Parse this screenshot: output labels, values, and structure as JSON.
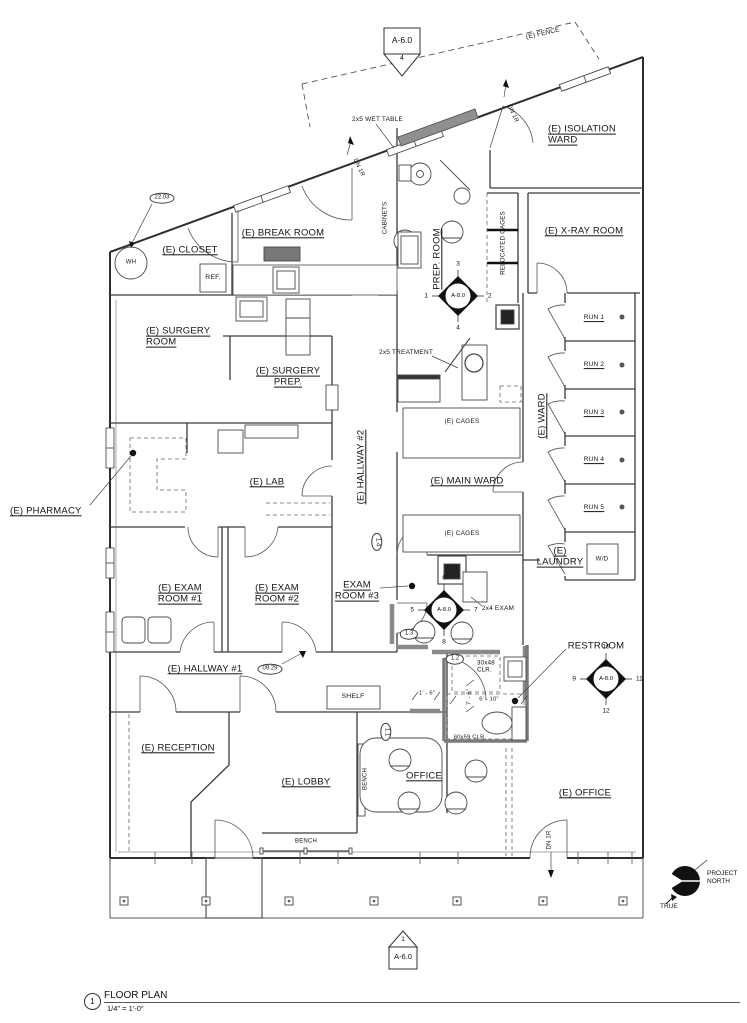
{
  "sheet_top": {
    "label": "A-6.0",
    "number": "4"
  },
  "sheet_bottom": {
    "label": "A-6.0",
    "number": "1"
  },
  "title_block": {
    "number": "1",
    "title": "FLOOR PLAN",
    "scale": "1/4\" = 1'-0\""
  },
  "north": {
    "project": "PROJECT\nNORTH",
    "true_label": "TRUE"
  },
  "plan": {
    "labels": [
      {
        "id": "room-label-isolation-ward",
        "text": "(E) ISOLATION\nWARD",
        "x": 548,
        "y": 135,
        "size": 9.5,
        "ul": true,
        "align": "left"
      },
      {
        "id": "room-label-xray",
        "text": "(E) X-RAY ROOM",
        "x": 584,
        "y": 231,
        "size": 9.5,
        "ul": true
      },
      {
        "id": "room-label-break-room",
        "text": "(E) BREAK ROOM",
        "x": 283,
        "y": 233,
        "size": 9.5,
        "ul": true
      },
      {
        "id": "room-label-closet",
        "text": "(E) CLOSET",
        "x": 190,
        "y": 250,
        "size": 9.5,
        "ul": true
      },
      {
        "id": "room-label-surgery-room",
        "text": "(E) SURGERY\nROOM",
        "x": 146,
        "y": 337,
        "size": 9.5,
        "ul": true,
        "align": "left"
      },
      {
        "id": "room-label-surgery-prep",
        "text": "(E) SURGERY\nPREP.",
        "x": 288,
        "y": 377,
        "size": 9.5,
        "ul": true
      },
      {
        "id": "room-label-prep-room",
        "text": "PREP. ROOM",
        "x": 437,
        "y": 259,
        "size": 9.5,
        "ul": true,
        "rot": -90
      },
      {
        "id": "room-label-hallway-2",
        "text": "(E) HALLWAY #2",
        "x": 361,
        "y": 467,
        "size": 9.5,
        "ul": true,
        "rot": -90
      },
      {
        "id": "room-label-main-ward",
        "text": "(E) MAIN WARD",
        "x": 467,
        "y": 481,
        "size": 9.5,
        "ul": true
      },
      {
        "id": "room-label-ward",
        "text": "(E) WARD",
        "x": 542,
        "y": 416,
        "size": 9.5,
        "ul": true,
        "rot": -90
      },
      {
        "id": "room-label-lab",
        "text": "(E) LAB",
        "x": 267,
        "y": 482,
        "size": 9.5,
        "ul": true
      },
      {
        "id": "room-label-pharmacy",
        "text": "(E)  PHARMACY",
        "x": 10,
        "y": 511,
        "size": 9.5,
        "ul": true,
        "align": "left"
      },
      {
        "id": "room-label-exam-1",
        "text": "(E) EXAM\nROOM #1",
        "x": 180,
        "y": 594,
        "size": 9.5,
        "ul": true
      },
      {
        "id": "room-label-exam-2",
        "text": "(E) EXAM\nROOM #2",
        "x": 277,
        "y": 594,
        "size": 9.5,
        "ul": true
      },
      {
        "id": "room-label-exam-3",
        "text": "EXAM\nROOM #3",
        "x": 357,
        "y": 591,
        "size": 9.5,
        "ul": true
      },
      {
        "id": "room-label-hallway-1",
        "text": "(E) HALLWAY #1",
        "x": 205,
        "y": 669,
        "size": 9.5,
        "ul": true
      },
      {
        "id": "room-label-laundry",
        "text": "(E)\nLAUNDRY",
        "x": 560,
        "y": 557,
        "size": 9.5,
        "ul": true
      },
      {
        "id": "room-label-restroom",
        "text": "RESTROOM",
        "x": 596,
        "y": 646,
        "size": 9.5
      },
      {
        "id": "room-label-reception",
        "text": "(E) RECEPTION",
        "x": 178,
        "y": 748,
        "size": 9.5,
        "ul": true
      },
      {
        "id": "room-label-lobby",
        "text": "(E) LOBBY",
        "x": 306,
        "y": 782,
        "size": 9.5,
        "ul": true
      },
      {
        "id": "room-label-office",
        "text": "OFFICE",
        "x": 424,
        "y": 776,
        "size": 9.5,
        "ul": true
      },
      {
        "id": "room-label-e-office",
        "text": "(E) OFFICE",
        "x": 585,
        "y": 793,
        "size": 9.5,
        "ul": true
      },
      {
        "id": "run-label-1",
        "text": "RUN 1",
        "x": 594,
        "y": 318,
        "size": 6.5,
        "ul": true
      },
      {
        "id": "run-label-2",
        "text": "RUN 2",
        "x": 594,
        "y": 365,
        "size": 6.5,
        "ul": true
      },
      {
        "id": "run-label-3",
        "text": "RUN 3",
        "x": 594,
        "y": 413,
        "size": 6.5,
        "ul": true
      },
      {
        "id": "run-label-4",
        "text": "RUN 4",
        "x": 594,
        "y": 460,
        "size": 6.5,
        "ul": true
      },
      {
        "id": "run-label-5",
        "text": "RUN 5",
        "x": 594,
        "y": 508,
        "size": 6.5,
        "ul": true
      },
      {
        "id": "anno-wet-table",
        "text": "2x5 WET TABLE",
        "x": 352,
        "y": 120,
        "size": 6.5,
        "align": "left"
      },
      {
        "id": "anno-treatment",
        "text": "2x5 TREATMENT",
        "x": 379,
        "y": 353,
        "size": 6.5,
        "align": "left"
      },
      {
        "id": "anno-cabinets",
        "text": "CABINETS",
        "x": 385,
        "y": 218,
        "size": 6.2,
        "rot": -90
      },
      {
        "id": "anno-relocated-cages",
        "text": "RELOCATED CAGES",
        "x": 503,
        "y": 243,
        "size": 6.2,
        "rot": -90
      },
      {
        "id": "anno-cages-1",
        "text": "(E) CAGES",
        "x": 462,
        "y": 422,
        "size": 6.5
      },
      {
        "id": "anno-cages-2",
        "text": "(E) CAGES",
        "x": 462,
        "y": 534,
        "size": 6.5
      },
      {
        "id": "anno-2x4-exam",
        "text": "2x4 EXAM",
        "x": 498,
        "y": 609,
        "size": 6.5
      },
      {
        "id": "anno-30x48-clr",
        "text": "30x48\nCLR.",
        "x": 477,
        "y": 667,
        "size": 6.2,
        "align": "left"
      },
      {
        "id": "anno-60x59-clr",
        "text": "60x59 CLR.",
        "x": 470,
        "y": 738,
        "size": 5.8
      },
      {
        "id": "anno-wd",
        "text": "W/D",
        "x": 602,
        "y": 559,
        "size": 6.2
      },
      {
        "id": "anno-ref",
        "text": "REF.",
        "x": 213,
        "y": 278,
        "size": 6.8
      },
      {
        "id": "anno-shelf",
        "text": "SHELF",
        "x": 353,
        "y": 697,
        "size": 6.8
      },
      {
        "id": "anno-bench-v",
        "text": "BENCH",
        "x": 366,
        "y": 779,
        "size": 6,
        "rot": -90
      },
      {
        "id": "anno-bench-h",
        "text": "BENCH",
        "x": 306,
        "y": 842,
        "size": 6
      },
      {
        "id": "anno-wh",
        "text": "WH",
        "x": 131,
        "y": 263,
        "size": 6
      },
      {
        "id": "anno-dn1r-a",
        "text": "DN 1R",
        "x": 358,
        "y": 168,
        "size": 6,
        "rot": 65
      },
      {
        "id": "anno-dn1r-b",
        "text": "DN 1R",
        "x": 512,
        "y": 114,
        "size": 6,
        "rot": 65
      },
      {
        "id": "anno-dn1r-c",
        "text": "DN 1R",
        "x": 550,
        "y": 840,
        "size": 6,
        "rot": -90
      },
      {
        "id": "anno-fence",
        "text": "(E) FENCE",
        "x": 543,
        "y": 34,
        "size": 6.5,
        "rot": -13
      },
      {
        "id": "dim-1-6",
        "text": "1' - 6\"",
        "x": 427,
        "y": 694,
        "size": 5.8
      },
      {
        "id": "dim-7-6",
        "text": "7' - 6\"",
        "x": 470,
        "y": 697,
        "size": 5.8,
        "rot": -90
      },
      {
        "id": "dim-6-10",
        "text": "6' - 10\"",
        "x": 489,
        "y": 700,
        "size": 5.8
      }
    ],
    "ovals": [
      {
        "id": "marker-22-03",
        "text": "22.03",
        "x": 162,
        "y": 198
      },
      {
        "id": "marker-09-29",
        "text": "09.29",
        "x": 270,
        "y": 669
      },
      {
        "id": "marker-1-4",
        "text": "1.4",
        "x": 377,
        "y": 542,
        "rot": 90
      },
      {
        "id": "marker-1-3",
        "text": "1.3",
        "x": 409,
        "y": 634
      },
      {
        "id": "marker-1-2",
        "text": "1.2",
        "x": 455,
        "y": 659
      },
      {
        "id": "marker-1-1",
        "text": "1.1",
        "x": 386,
        "y": 732,
        "rot": 90
      }
    ],
    "diamonds": [
      {
        "id": "elev-marker-a8-1",
        "label": "A-8.0",
        "cx": 458,
        "cy": 296,
        "top": "3",
        "left": "1",
        "right": "2",
        "bottom": "4"
      },
      {
        "id": "elev-marker-a8-2",
        "label": "A-8.0",
        "cx": 444,
        "cy": 610,
        "top": "6",
        "left": "5",
        "right": "7",
        "bottom": "8"
      },
      {
        "id": "elev-marker-a8-3",
        "label": "A-8.0",
        "cx": 606,
        "cy": 679,
        "top": "10",
        "left": "9",
        "right": "11",
        "bottom": "12"
      }
    ]
  }
}
